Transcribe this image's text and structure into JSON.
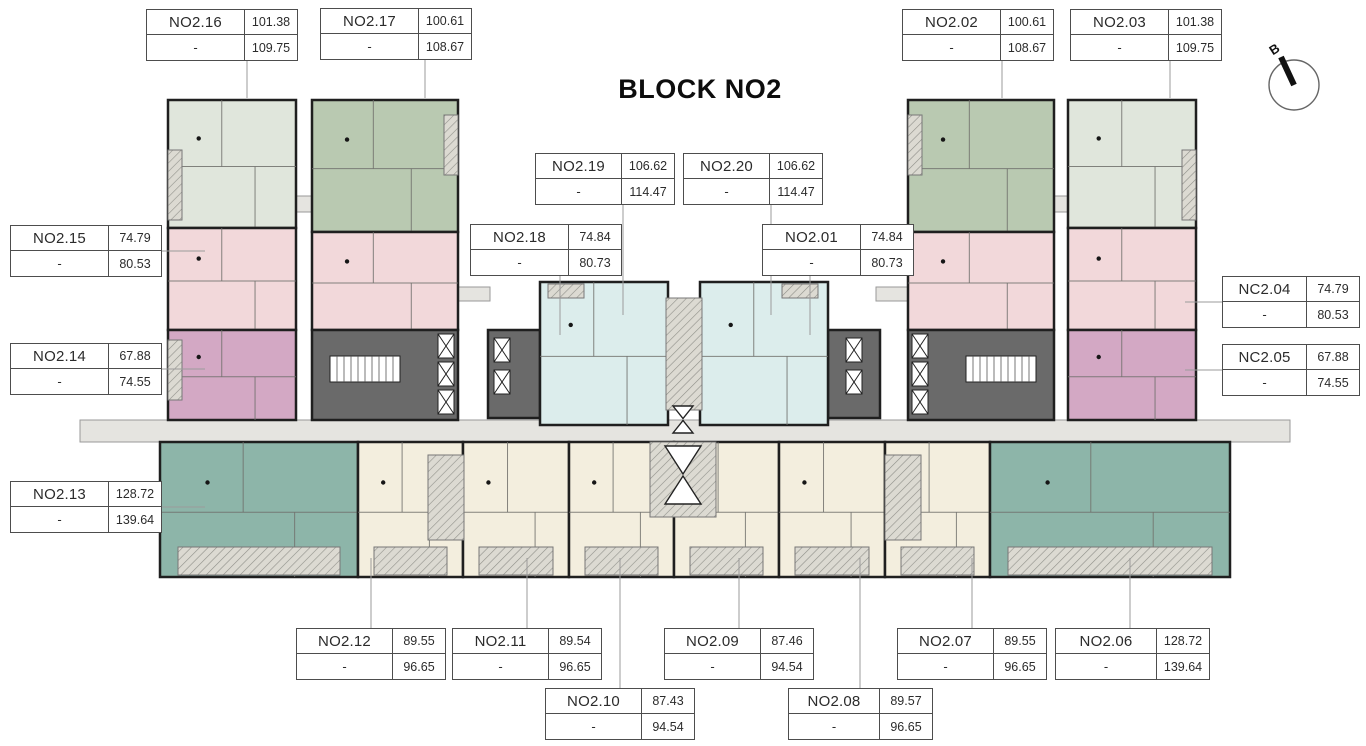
{
  "title": "BLOCK NO2",
  "compass": {
    "label": "B"
  },
  "colors": {
    "wall": "#1f1f1f",
    "sage_light": "#e0e6dc",
    "sage_dark": "#b9c9b1",
    "pink": "#f2d8da",
    "mauve": "#d3a8c4",
    "cyan": "#dcedec",
    "cream": "#f3eede",
    "teal": "#8db5a9",
    "core": "#6a6a6a",
    "corridor": "#e5e4e0",
    "hatch_bg": "#dcdad2",
    "hatch_line": "#90908a",
    "room_line": "#70706c",
    "leader": "#9b9b9b",
    "label_border": "#4d4d4d",
    "text": "#2b2b2b"
  },
  "units": [
    {
      "id": "NO2.16",
      "dash": "-",
      "area1": "101.38",
      "area2": "109.75"
    },
    {
      "id": "NO2.17",
      "dash": "-",
      "area1": "100.61",
      "area2": "108.67"
    },
    {
      "id": "NO2.02",
      "dash": "-",
      "area1": "100.61",
      "area2": "108.67"
    },
    {
      "id": "NO2.03",
      "dash": "-",
      "area1": "101.38",
      "area2": "109.75"
    },
    {
      "id": "NO2.19",
      "dash": "-",
      "area1": "106.62",
      "area2": "114.47"
    },
    {
      "id": "NO2.20",
      "dash": "-",
      "area1": "106.62",
      "area2": "114.47"
    },
    {
      "id": "NO2.15",
      "dash": "-",
      "area1": "74.79",
      "area2": "80.53"
    },
    {
      "id": "NO2.18",
      "dash": "-",
      "area1": "74.84",
      "area2": "80.73"
    },
    {
      "id": "NO2.01",
      "dash": "-",
      "area1": "74.84",
      "area2": "80.73"
    },
    {
      "id": "NC2.04",
      "dash": "-",
      "area1": "74.79",
      "area2": "80.53"
    },
    {
      "id": "NO2.14",
      "dash": "-",
      "area1": "67.88",
      "area2": "74.55"
    },
    {
      "id": "NC2.05",
      "dash": "-",
      "area1": "67.88",
      "area2": "74.55"
    },
    {
      "id": "NO2.13",
      "dash": "-",
      "area1": "128.72",
      "area2": "139.64"
    },
    {
      "id": "NO2.12",
      "dash": "-",
      "area1": "89.55",
      "area2": "96.65"
    },
    {
      "id": "NO2.11",
      "dash": "-",
      "area1": "89.54",
      "area2": "96.65"
    },
    {
      "id": "NO2.09",
      "dash": "-",
      "area1": "87.46",
      "area2": "94.54"
    },
    {
      "id": "NO2.07",
      "dash": "-",
      "area1": "89.55",
      "area2": "96.65"
    },
    {
      "id": "NO2.06",
      "dash": "-",
      "area1": "128.72",
      "area2": "139.64"
    },
    {
      "id": "NO2.10",
      "dash": "-",
      "area1": "87.43",
      "area2": "94.54"
    },
    {
      "id": "NO2.08",
      "dash": "-",
      "area1": "89.57",
      "area2": "96.65"
    }
  ]
}
